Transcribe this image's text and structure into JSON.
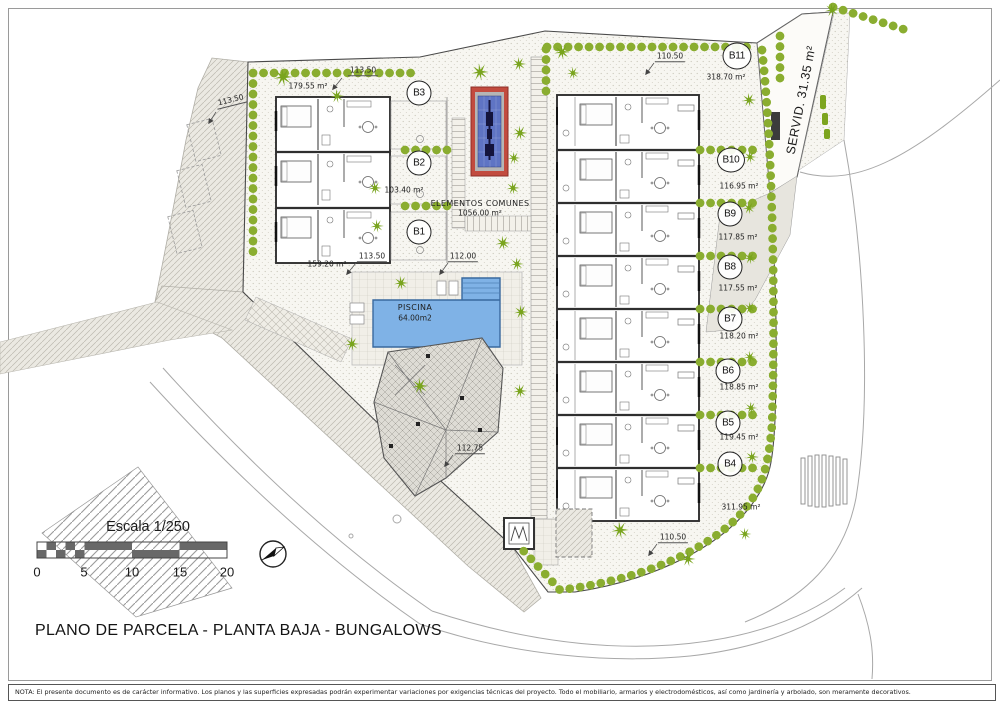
{
  "title": "PLANO DE PARCELA - PLANTA BAJA - BUNGALOWS",
  "note": "NOTA: El presente documento es de carácter informativo. Los planos y las superficies expresadas podrán experimentar variaciones por exigencias técnicas del proyecto. Todo el mobiliario, armarios y electrodomésticos, así como jardinería y arbolado, son meramente decorativos.",
  "scale_bar": {
    "label": "Escala 1/250",
    "ticks": [
      "0",
      "5",
      "10",
      "15",
      "20"
    ]
  },
  "areas": {
    "common_label": "ELEMENTOS COMUNES",
    "common_area": "1056.00 m²",
    "pool_label": "PISCINA",
    "pool_area": "64.00m2",
    "servitude": "SERVID. 31.35 m²"
  },
  "bungalows": [
    {
      "id": "B1",
      "area": "159.20 m²"
    },
    {
      "id": "B2",
      "area": "103.40 m²"
    },
    {
      "id": "B3",
      "area": "179.55 m²"
    },
    {
      "id": "B4",
      "area": "311.95 m²"
    },
    {
      "id": "B5",
      "area": "119.45 m²"
    },
    {
      "id": "B6",
      "area": "118.85 m²"
    },
    {
      "id": "B7",
      "area": "118.20 m²"
    },
    {
      "id": "B8",
      "area": "117.55 m²"
    },
    {
      "id": "B9",
      "area": "117.85 m²"
    },
    {
      "id": "B10",
      "area": "116.95 m²"
    },
    {
      "id": "B11",
      "area": "318.70 m²"
    }
  ],
  "dimensions": {
    "width_top": "113.50",
    "width_left": "113.50",
    "width_bottom": "113.50",
    "width_mid": "112.00",
    "width_right_top": "110.50",
    "width_right_bottom": "110.50",
    "width_roof": "112.75"
  },
  "colors": {
    "hedge_green": "#8aad30",
    "pool_blue": "#7fb2e6",
    "playground_red": "#c24b3f",
    "playground_blue": "#5f74c4"
  }
}
